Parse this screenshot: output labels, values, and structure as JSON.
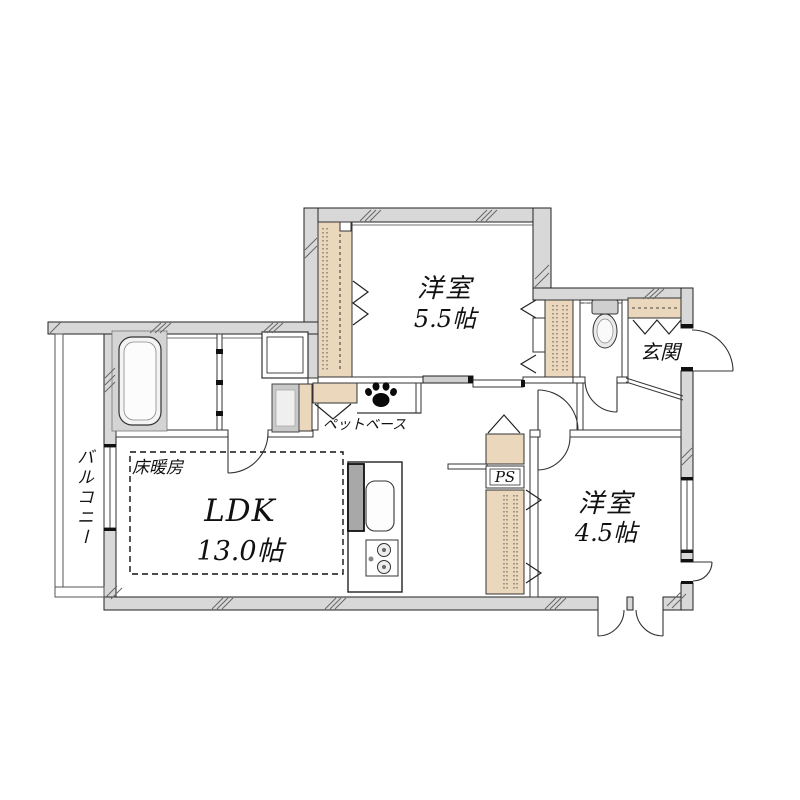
{
  "document": {
    "type": "floor-plan",
    "background": "#ffffff"
  },
  "colors": {
    "wall_fill": "#d8d8d8",
    "closet_fill": "#ead7bc",
    "line": "#222222",
    "text": "#111111",
    "bath_floor": "#d4d4d4"
  },
  "plan": {
    "rooms": {
      "bedroom1": {
        "label": "洋室",
        "size": "5.5帖"
      },
      "bedroom2": {
        "label": "洋室",
        "size": "4.5帖"
      },
      "ldk": {
        "label": "LDK",
        "size": "13.0帖"
      },
      "entrance": {
        "label": "玄関"
      },
      "balcony": {
        "label": "バルコニー"
      },
      "floor_heating": {
        "label": "床暖房"
      },
      "pet_base": {
        "label": "ペットベース"
      },
      "pipe_space": {
        "label": "PS"
      }
    },
    "icons": [
      "paw-icon",
      "bathtub-icon",
      "toilet-icon",
      "sink-icon",
      "stove-icon",
      "washing-machine-icon",
      "vanity-icon"
    ]
  }
}
